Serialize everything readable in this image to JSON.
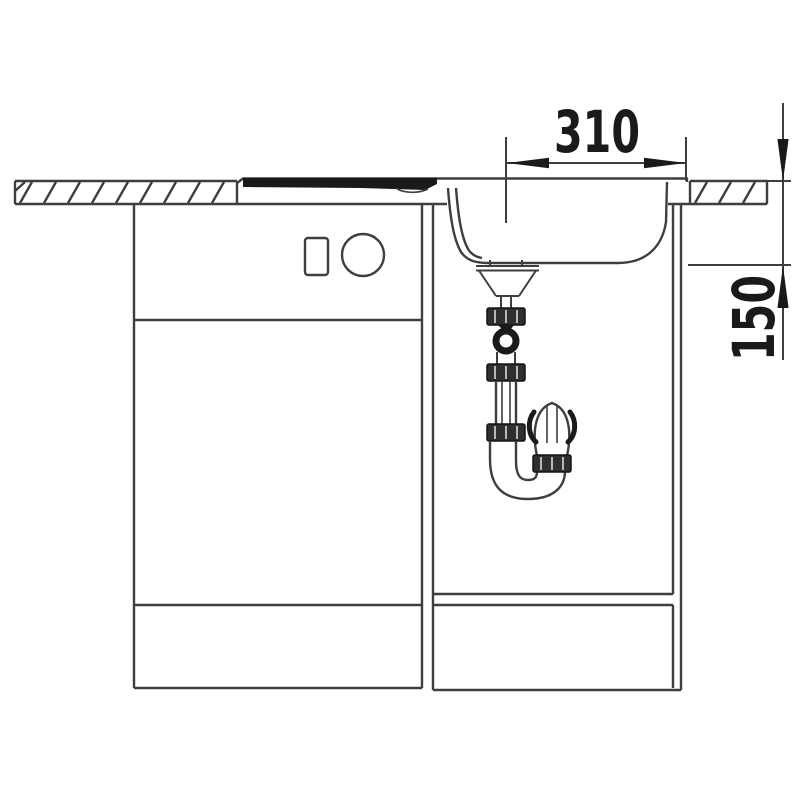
{
  "diagram": {
    "dimensions": [
      {
        "id": "width",
        "value": "310"
      },
      {
        "id": "depth",
        "value": "150"
      }
    ],
    "colors": {
      "background": "#ffffff",
      "line": "#3e3e3e",
      "dark": "#1a1a1a"
    }
  }
}
